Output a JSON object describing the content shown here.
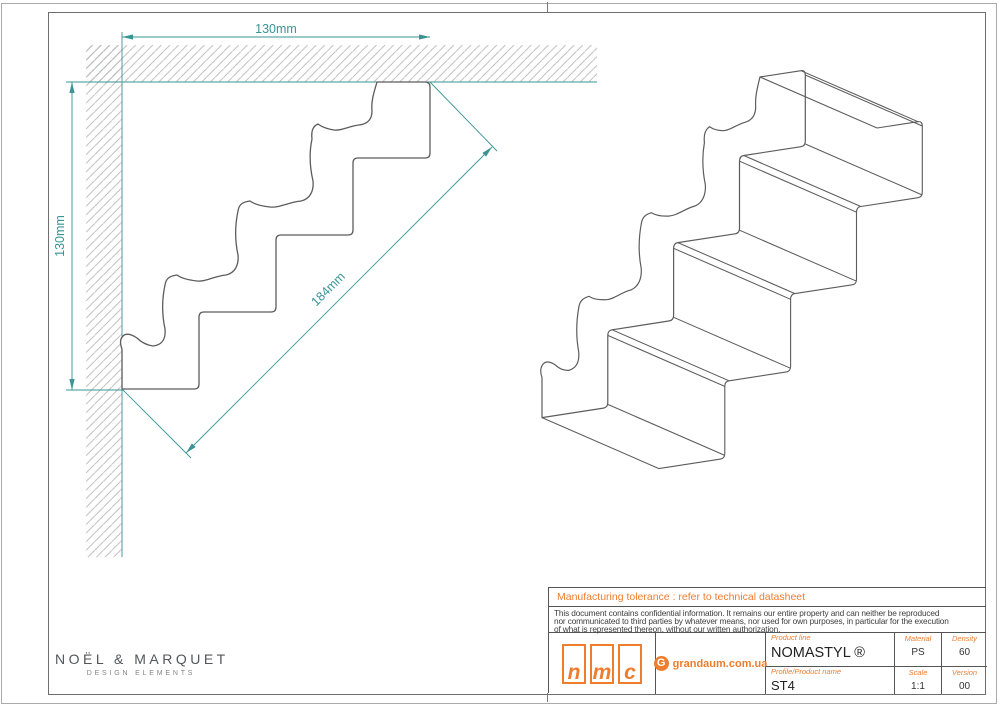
{
  "drawing": {
    "dimensions": {
      "top": "130mm",
      "left": "130mm",
      "diagonal": "184mm"
    }
  },
  "logo": {
    "name": "NOËL & MARQUET",
    "sub": "DESIGN ELEMENTS"
  },
  "title_block": {
    "tolerance_note": "Manufacturing tolerance : refer to technical datasheet",
    "confidential_lines": [
      "This document contains confidential information. It remains our entire property and can neither be reproduced",
      "nor communicated to third parties by whatever means, nor used for own purposes, in particular for the execution",
      "of what is represented thereon, without our written authorization."
    ],
    "nmc_letters": [
      "n",
      "m",
      "c"
    ],
    "partner_icon_letter": "G",
    "partner": "grandaum.com.ua",
    "product_line_label": "Product line",
    "product_line": "NOMASTYL ®",
    "product_name_label": "Profile/Product name",
    "product_name": "ST4",
    "fields": [
      {
        "label": "Material",
        "value": "PS"
      },
      {
        "label": "Density",
        "value": "60"
      },
      {
        "label": "Scale",
        "value": "1:1"
      },
      {
        "label": "Version",
        "value": "00"
      }
    ]
  },
  "colors": {
    "teal": "#3a9494",
    "orange": "#ee7d2e",
    "line": "#5c5c5c",
    "hatch": "#b4b8b4",
    "border": "#6e6e6e"
  }
}
